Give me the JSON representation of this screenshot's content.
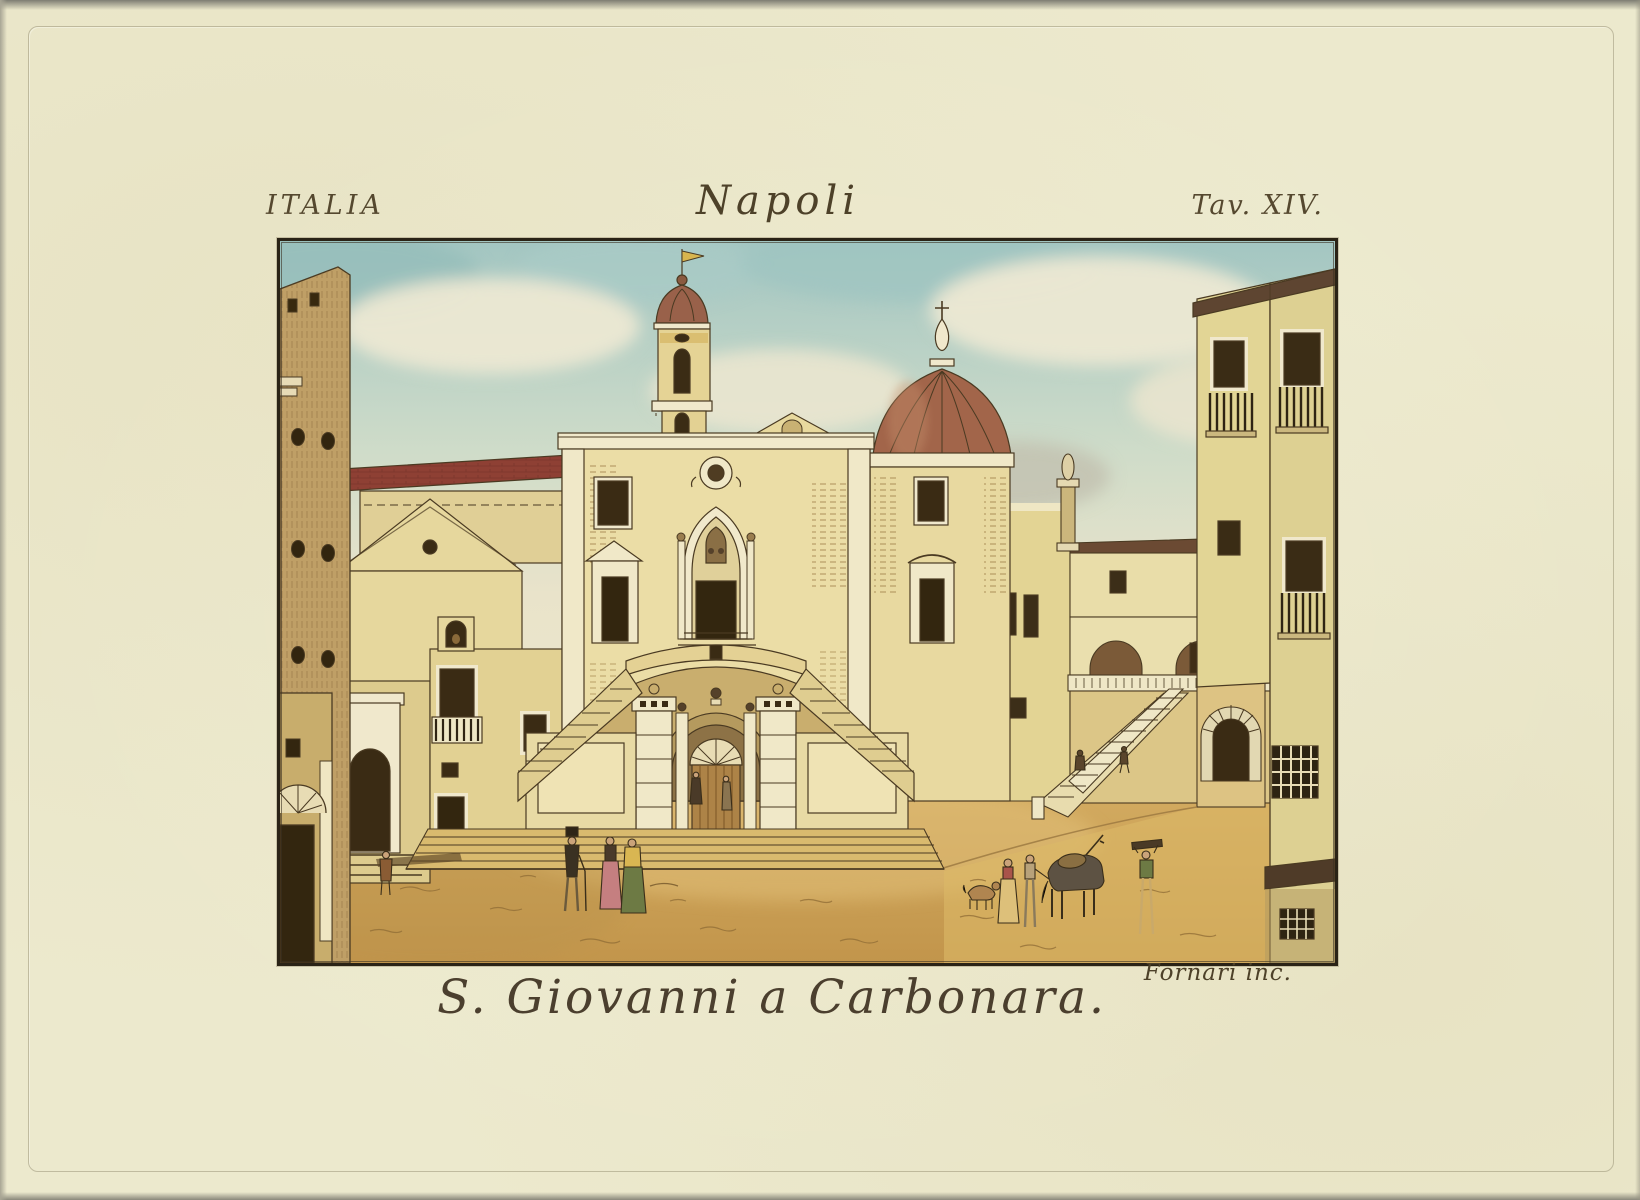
{
  "artwork": {
    "region_label": "ITALIA",
    "city_label": "Napoli",
    "plate_label": "Tav. XIV.",
    "engraver_credit": "Fornari inc.",
    "title": "S. Giovanni a Carbonara.",
    "description": "Hand-colored engraving: piazza view of the church of S. Giovanni a Carbonara in Naples, with bell tower, ribbed dome, horseshoe double staircase over an arched gate, flanking buildings, grand side stair with balustrade, and small figures, animals and a dog in the foreground."
  },
  "palette": {
    "paper": "#ece9cd",
    "ink": "#4a3a22",
    "sky_teal": "#a3c6c2",
    "cloud_cream": "#ece8d3",
    "wall_yellow": "#e7d89c",
    "wall_shadow": "#c9b173",
    "trim_white": "#f0e8c8",
    "dome_red": "#9c5f46",
    "roof_red": "#8e4034",
    "ground_tan": "#d2a85c",
    "opening_dark": "#37290f",
    "flag_yellow": "#d8b54e"
  }
}
